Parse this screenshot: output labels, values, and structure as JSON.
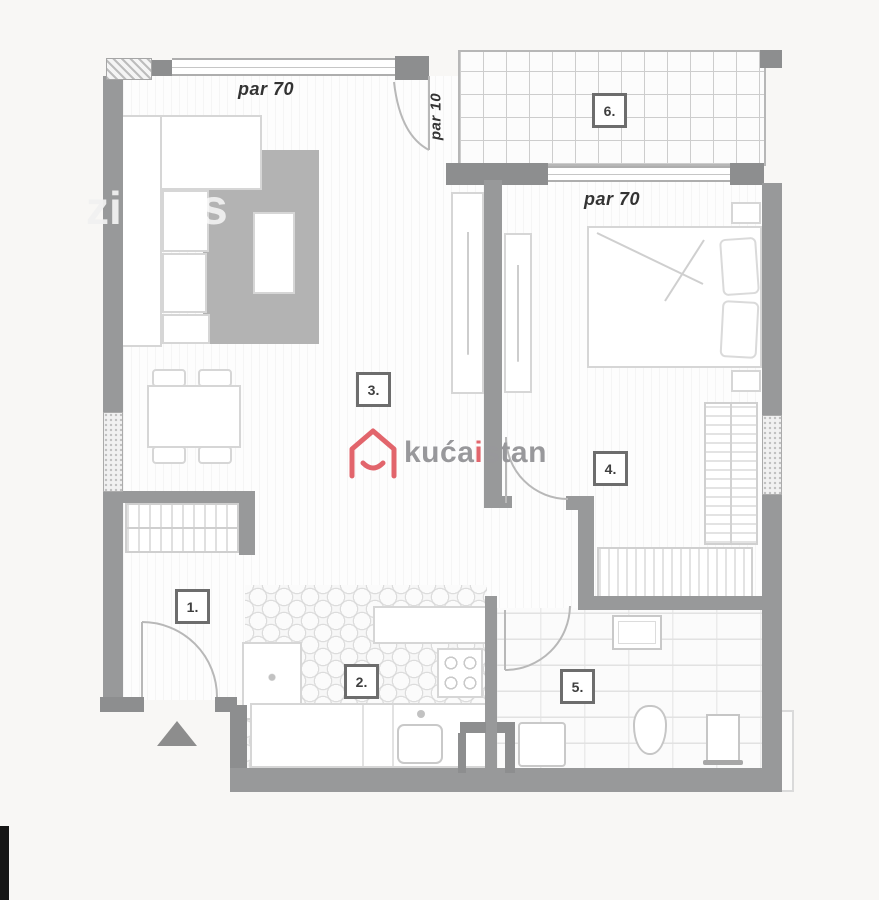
{
  "plan": {
    "type": "apartment-floor-plan",
    "rooms": [
      {
        "number": "1."
      },
      {
        "number": "2."
      },
      {
        "number": "3."
      },
      {
        "number": "4."
      },
      {
        "number": "5."
      },
      {
        "number": "6."
      }
    ],
    "annotations": {
      "parapet_top": "par 70",
      "parapet_terrace_door": "par 10",
      "parapet_bedroom": "par 70"
    }
  },
  "logo": {
    "part1": "kuća",
    "accent": "i",
    "part2": "stan",
    "house_icon_color": "#e2656c",
    "text_color": "#98989b"
  },
  "watermark": {
    "left_letters": "zi",
    "mid_letter": "s"
  },
  "colors": {
    "background": "#f8f7f5",
    "wall": "#98999a",
    "wall_dark": "#8d8e8f",
    "floor": "#fdfdfd",
    "rug": "#b3b3b3",
    "accent_pink": "#e2656c",
    "label_border": "#6d6d6d",
    "annotation_text": "#333333"
  }
}
